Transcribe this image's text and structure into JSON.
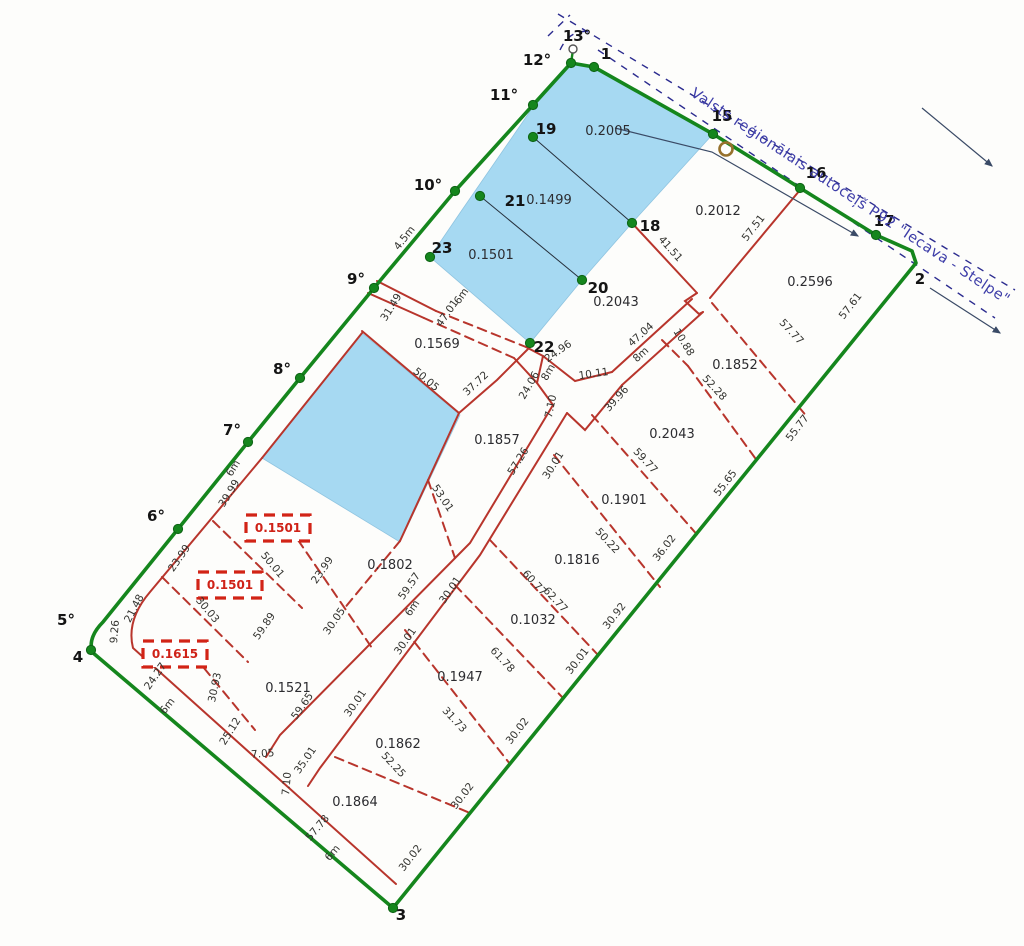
{
  "road_label": "Valsts reģionālais autoceļš P92 \"Iecava - Stelpe\"",
  "colors": {
    "boundary_green": "#15861d",
    "boundary_green_dark": "#0d6314",
    "parcel_red": "#b8352c",
    "box_red": "#d22417",
    "water_blue_fill": "#a6d9f2",
    "road_line_navy": "#2b2b8f",
    "road_text_blue": "#3d3da8",
    "thin_line": "#3a4a66",
    "marker_brown": "#96712c"
  },
  "parcels": [
    {
      "label": "0.2005",
      "x": 608,
      "y": 131
    },
    {
      "label": "0.1499",
      "x": 549,
      "y": 200
    },
    {
      "label": "0.1501",
      "x": 491,
      "y": 255
    },
    {
      "label": "0.2012",
      "x": 718,
      "y": 211
    },
    {
      "label": "0.2596",
      "x": 810,
      "y": 282
    },
    {
      "label": "0.2043",
      "x": 616,
      "y": 302
    },
    {
      "label": "0.1569",
      "x": 437,
      "y": 344
    },
    {
      "label": "0.1852",
      "x": 735,
      "y": 365
    },
    {
      "label": "0.2043",
      "x": 672,
      "y": 434
    },
    {
      "label": "0.1857",
      "x": 497,
      "y": 440
    },
    {
      "label": "0.1901",
      "x": 624,
      "y": 500
    },
    {
      "label": "0.1816",
      "x": 577,
      "y": 560
    },
    {
      "label": "0.1802",
      "x": 390,
      "y": 565
    },
    {
      "label": "0.1032",
      "x": 533,
      "y": 620
    },
    {
      "label": "0.1521",
      "x": 288,
      "y": 688
    },
    {
      "label": "0.1947",
      "x": 460,
      "y": 677
    },
    {
      "label": "0.1862",
      "x": 398,
      "y": 744
    },
    {
      "label": "0.1864",
      "x": 355,
      "y": 802
    }
  ],
  "boxed_parcels": [
    {
      "label": "0.1501",
      "x": 278,
      "y": 528
    },
    {
      "label": "0.1501",
      "x": 230,
      "y": 585
    },
    {
      "label": "0.1615",
      "x": 175,
      "y": 654
    }
  ],
  "vertices": [
    {
      "label": "1",
      "x": 606,
      "y": 59
    },
    {
      "label": "2",
      "x": 920,
      "y": 284
    },
    {
      "label": "3",
      "x": 401,
      "y": 920
    },
    {
      "label": "4",
      "x": 78,
      "y": 662
    },
    {
      "label": "5°",
      "x": 66,
      "y": 625
    },
    {
      "label": "6°",
      "x": 156,
      "y": 521
    },
    {
      "label": "7°",
      "x": 232,
      "y": 435
    },
    {
      "label": "8°",
      "x": 282,
      "y": 374
    },
    {
      "label": "9°",
      "x": 356,
      "y": 284
    },
    {
      "label": "10°",
      "x": 428,
      "y": 190
    },
    {
      "label": "11°",
      "x": 504,
      "y": 100
    },
    {
      "label": "12°",
      "x": 537,
      "y": 65
    },
    {
      "label": "13°",
      "x": 577,
      "y": 41
    },
    {
      "label": "15",
      "x": 722,
      "y": 121
    },
    {
      "label": "16",
      "x": 816,
      "y": 178
    },
    {
      "label": "17",
      "x": 884,
      "y": 226
    },
    {
      "label": "18",
      "x": 650,
      "y": 231
    },
    {
      "label": "19",
      "x": 546,
      "y": 134
    },
    {
      "label": "20",
      "x": 598,
      "y": 293
    },
    {
      "label": "21",
      "x": 515,
      "y": 206
    },
    {
      "label": "22",
      "x": 544,
      "y": 352
    },
    {
      "label": "23",
      "x": 442,
      "y": 253
    }
  ],
  "dimensions": [
    {
      "t": "4.5m",
      "x": 407,
      "y": 240,
      "r": -52
    },
    {
      "t": "31.49",
      "x": 394,
      "y": 309,
      "r": -58
    },
    {
      "t": "47.01",
      "x": 450,
      "y": 315,
      "r": -55
    },
    {
      "t": "6m",
      "x": 464,
      "y": 298,
      "r": -55
    },
    {
      "t": "50.05",
      "x": 424,
      "y": 382,
      "r": 40
    },
    {
      "t": "37.72",
      "x": 478,
      "y": 386,
      "r": -43
    },
    {
      "t": "24.96",
      "x": 560,
      "y": 354,
      "r": -35
    },
    {
      "t": "8m",
      "x": 551,
      "y": 374,
      "r": -60
    },
    {
      "t": "24.06",
      "x": 532,
      "y": 387,
      "r": -60
    },
    {
      "t": "7.10",
      "x": 554,
      "y": 407,
      "r": -78
    },
    {
      "t": "10.11",
      "x": 594,
      "y": 377,
      "r": -8
    },
    {
      "t": "57.26",
      "x": 521,
      "y": 463,
      "r": -58
    },
    {
      "t": "30.01",
      "x": 556,
      "y": 467,
      "r": -58
    },
    {
      "t": "53.01",
      "x": 440,
      "y": 500,
      "r": 56
    },
    {
      "t": "39.96",
      "x": 619,
      "y": 401,
      "r": -48
    },
    {
      "t": "47.04",
      "x": 643,
      "y": 337,
      "r": -42
    },
    {
      "t": "8m",
      "x": 643,
      "y": 357,
      "r": -42
    },
    {
      "t": "10.88",
      "x": 681,
      "y": 344,
      "r": 58
    },
    {
      "t": "41.51",
      "x": 668,
      "y": 251,
      "r": 48
    },
    {
      "t": "57.51",
      "x": 756,
      "y": 230,
      "r": -52
    },
    {
      "t": "57.77",
      "x": 789,
      "y": 334,
      "r": 47
    },
    {
      "t": "52.28",
      "x": 712,
      "y": 390,
      "r": 47
    },
    {
      "t": "59.77",
      "x": 643,
      "y": 463,
      "r": 47
    },
    {
      "t": "50.22",
      "x": 605,
      "y": 543,
      "r": 47
    },
    {
      "t": "60.77",
      "x": 532,
      "y": 585,
      "r": 47
    },
    {
      "t": "62.77",
      "x": 553,
      "y": 602,
      "r": 47
    },
    {
      "t": "61.78",
      "x": 500,
      "y": 662,
      "r": 47
    },
    {
      "t": "31.73",
      "x": 452,
      "y": 722,
      "r": 47
    },
    {
      "t": "52.25",
      "x": 391,
      "y": 767,
      "r": 47
    },
    {
      "t": "57.61",
      "x": 853,
      "y": 308,
      "r": -52
    },
    {
      "t": "55.77",
      "x": 800,
      "y": 430,
      "r": -52
    },
    {
      "t": "55.65",
      "x": 728,
      "y": 485,
      "r": -52
    },
    {
      "t": "36.02",
      "x": 667,
      "y": 550,
      "r": -52
    },
    {
      "t": "30.92",
      "x": 617,
      "y": 618,
      "r": -52
    },
    {
      "t": "30.01",
      "x": 580,
      "y": 663,
      "r": -52
    },
    {
      "t": "30.02",
      "x": 520,
      "y": 733,
      "r": -52
    },
    {
      "t": "30.02",
      "x": 465,
      "y": 798,
      "r": -52
    },
    {
      "t": "30.02",
      "x": 413,
      "y": 860,
      "r": -52
    },
    {
      "t": "6m",
      "x": 236,
      "y": 470,
      "r": -58
    },
    {
      "t": "39.99",
      "x": 232,
      "y": 495,
      "r": -58
    },
    {
      "t": "23.99",
      "x": 182,
      "y": 560,
      "r": -55
    },
    {
      "t": "21.48",
      "x": 137,
      "y": 610,
      "r": -62
    },
    {
      "t": "9.26",
      "x": 118,
      "y": 632,
      "r": -85
    },
    {
      "t": "24.27",
      "x": 158,
      "y": 678,
      "r": -55
    },
    {
      "t": "30.93",
      "x": 218,
      "y": 688,
      "r": -78
    },
    {
      "t": "25.12",
      "x": 233,
      "y": 733,
      "r": -58
    },
    {
      "t": "7.05",
      "x": 263,
      "y": 757,
      "r": -5
    },
    {
      "t": "35.01",
      "x": 308,
      "y": 762,
      "r": -55
    },
    {
      "t": "7.10",
      "x": 290,
      "y": 784,
      "r": -85
    },
    {
      "t": "6m",
      "x": 170,
      "y": 708,
      "r": -52
    },
    {
      "t": "23.99",
      "x": 325,
      "y": 572,
      "r": -55
    },
    {
      "t": "50.01",
      "x": 270,
      "y": 567,
      "r": 50
    },
    {
      "t": "30.03",
      "x": 205,
      "y": 612,
      "r": 50
    },
    {
      "t": "59.89",
      "x": 267,
      "y": 628,
      "r": -55
    },
    {
      "t": "30.05",
      "x": 337,
      "y": 623,
      "r": -55
    },
    {
      "t": "59.65",
      "x": 305,
      "y": 708,
      "r": -55
    },
    {
      "t": "59.57",
      "x": 412,
      "y": 588,
      "r": -55
    },
    {
      "t": "6m",
      "x": 415,
      "y": 610,
      "r": -55
    },
    {
      "t": "30.01",
      "x": 453,
      "y": 592,
      "r": -55
    },
    {
      "t": "30.01",
      "x": 408,
      "y": 643,
      "r": -55
    },
    {
      "t": "30.01",
      "x": 358,
      "y": 705,
      "r": -55
    },
    {
      "t": "57.78",
      "x": 320,
      "y": 830,
      "r": -50
    },
    {
      "t": "6m",
      "x": 335,
      "y": 855,
      "r": -50
    }
  ],
  "geometry": {
    "green_boundary": "M571,63 L533,105 L455,191 L374,288 L300,378 L248,442 L178,529 L103,622 Q88,637 92,652 L393,908 L916,263 L912,251 L876,235 L800,188 L713,134 L594,67 Z",
    "green_spur": "M571,63 L573,50",
    "green_dots": [
      [
        594,
        67
      ],
      [
        571,
        63
      ],
      [
        713,
        134
      ],
      [
        800,
        188
      ],
      [
        876,
        235
      ],
      [
        393,
        908
      ],
      [
        91,
        650
      ],
      [
        178,
        529
      ],
      [
        248,
        442
      ],
      [
        300,
        378
      ],
      [
        374,
        288
      ],
      [
        455,
        191
      ],
      [
        533,
        105
      ],
      [
        632,
        223
      ],
      [
        533,
        137
      ],
      [
        480,
        196
      ],
      [
        582,
        280
      ],
      [
        530,
        343
      ],
      [
        430,
        257
      ]
    ],
    "open_circles": [
      [
        573,
        49
      ]
    ],
    "brown_circle": [
      726,
      149
    ],
    "blue_polygons": [
      [
        [
          575,
          64
        ],
        [
          594,
          67
        ],
        [
          713,
          134
        ],
        [
          632,
          223
        ],
        [
          582,
          280
        ],
        [
          530,
          343
        ],
        [
          430,
          257
        ],
        [
          462,
          210
        ],
        [
          533,
          107
        ],
        [
          571,
          63
        ]
      ],
      [
        [
          362,
          333
        ],
        [
          460,
          415
        ],
        [
          400,
          542
        ],
        [
          262,
          458
        ]
      ]
    ],
    "thin_black_lines": [
      [
        [
          533,
          137
        ],
        [
          632,
          223
        ]
      ],
      [
        [
          480,
          196
        ],
        [
          582,
          280
        ]
      ]
    ],
    "red_solid": [
      "M377,281 L436,311",
      "M368,293 L424,318",
      "M362,331 L459,413",
      "M530,347 L497,380 L459,413",
      "M459,413 L400,541",
      "M543,356 L537,383 L553,405",
      "M553,405 L470,543 L280,735 L266,757",
      "M567,413 L480,555 L320,768 L308,786",
      "M692,299 L612,372",
      "M703,312 L622,385",
      "M612,372 L575,381 L543,356",
      "M622,385 L585,430 L567,413",
      "M632,223 L697,293",
      "M800,190 L710,298",
      "M697,293 L685,301 L699,314 L703,312",
      "M362,333 L262,458",
      "M262,458 L150,592 Q126,620 133,648 L396,884",
      "M526,347 L543,356",
      "M514,358 L537,383"
    ],
    "red_dashed": [
      "M436,311 L526,347",
      "M424,318 L514,358",
      "M400,541 L343,610",
      "M712,303 L808,418",
      "M662,340 L688,366",
      "M688,366 L758,462",
      "M592,415 L700,538",
      "M554,455 L660,587",
      "M490,540 L598,655",
      "M455,585 L563,698",
      "M405,630 L510,764",
      "M335,757 L470,813",
      "M428,480 L455,558",
      "M213,521 L302,608",
      "M162,577 L248,662",
      "M185,645 L255,730",
      "M298,540 L372,648"
    ],
    "navy_dashed": [
      "M558,14 L1015,290",
      "M598,50 L995,318",
      "M548,36 L570,15",
      "M560,50 Q570,28 592,32"
    ],
    "arrow_lines": [
      "M615,128 L712,152 L858,236",
      "M922,108 L992,166",
      "M930,288 L1000,333"
    ],
    "road_text_pos": [
      848,
      200
    ],
    "road_text_rot": 33.5,
    "box_size": [
      64,
      26
    ]
  }
}
